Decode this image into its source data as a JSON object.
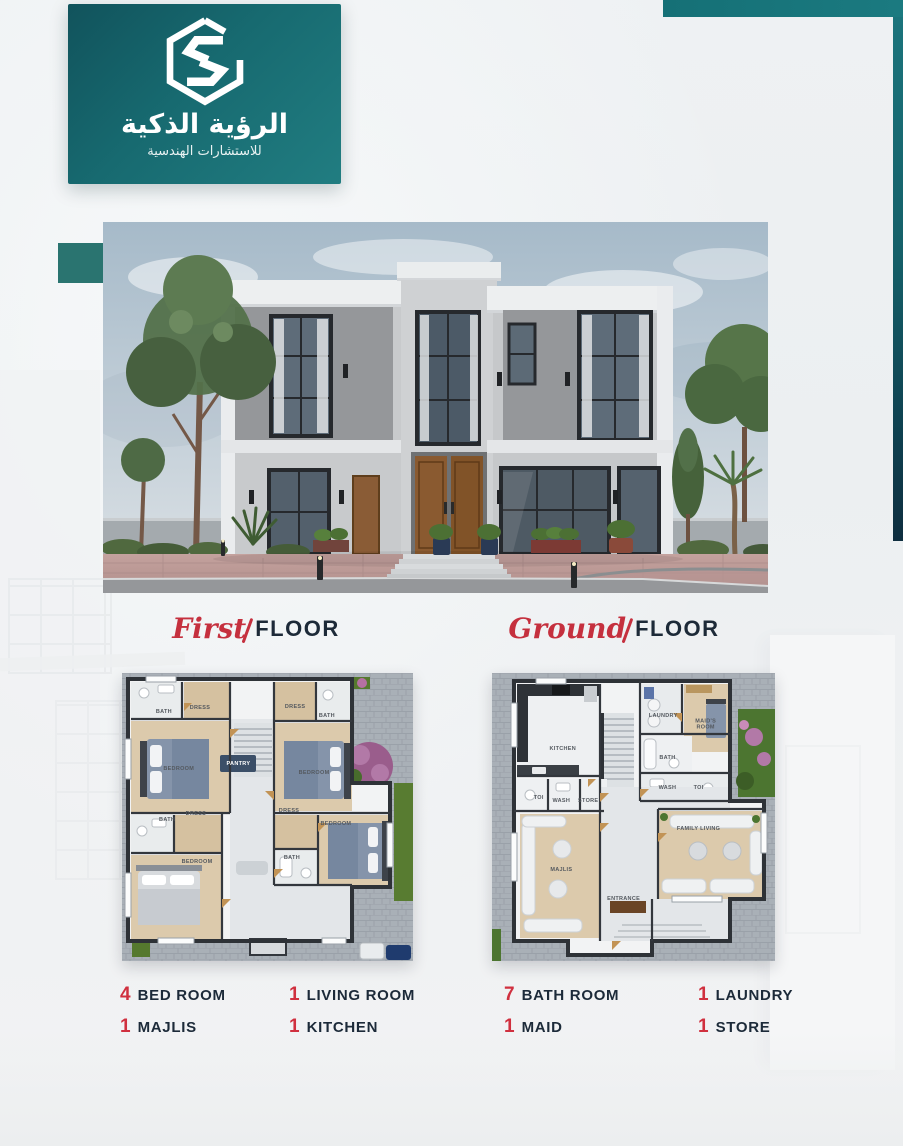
{
  "brand": {
    "logo_icon": "hexagon-s-logo",
    "title_ar": "الرؤية الذكية",
    "subtitle_ar": "للاستشارات الهندسية"
  },
  "hero": {
    "alt": "modern-two-storey-villa-render"
  },
  "sections": {
    "first_floor": {
      "script": "First",
      "word": "FLOOR"
    },
    "ground_floor": {
      "script": "Ground",
      "word": "FLOOR"
    }
  },
  "plans": {
    "first": {
      "rooms": [
        "BATH",
        "DRESS",
        "BEDROOM",
        "DRESS",
        "BATH",
        "BEDROOM",
        "PANTRY",
        "BATH",
        "DRESS",
        "BEDROOM",
        "DRESS",
        "BEDROOM",
        "BATH"
      ]
    },
    "ground": {
      "rooms": [
        "KITCHEN",
        "LAUNDRY",
        "MAID'S ROOM",
        "BATH",
        "WASH",
        "TOI",
        "TOI",
        "WASH",
        "STORE",
        "MAJLIS",
        "FAMILY LIVING",
        "ENTRANCE"
      ]
    }
  },
  "stats": [
    {
      "count": "4",
      "label": "BED ROOM"
    },
    {
      "count": "1",
      "label": "LIVING ROOM"
    },
    {
      "count": "7",
      "label": "BATH ROOM"
    },
    {
      "count": "1",
      "label": "LAUNDRY"
    },
    {
      "count": "1",
      "label": "MAJLIS"
    },
    {
      "count": "1",
      "label": "KITCHEN"
    },
    {
      "count": "1",
      "label": "MAID"
    },
    {
      "count": "1",
      "label": "STORE"
    }
  ],
  "colors": {
    "teal": "#1b6f75",
    "teal_dark": "#0e2e3f",
    "accent_red": "#d0303f",
    "navy": "#1c2a39"
  }
}
